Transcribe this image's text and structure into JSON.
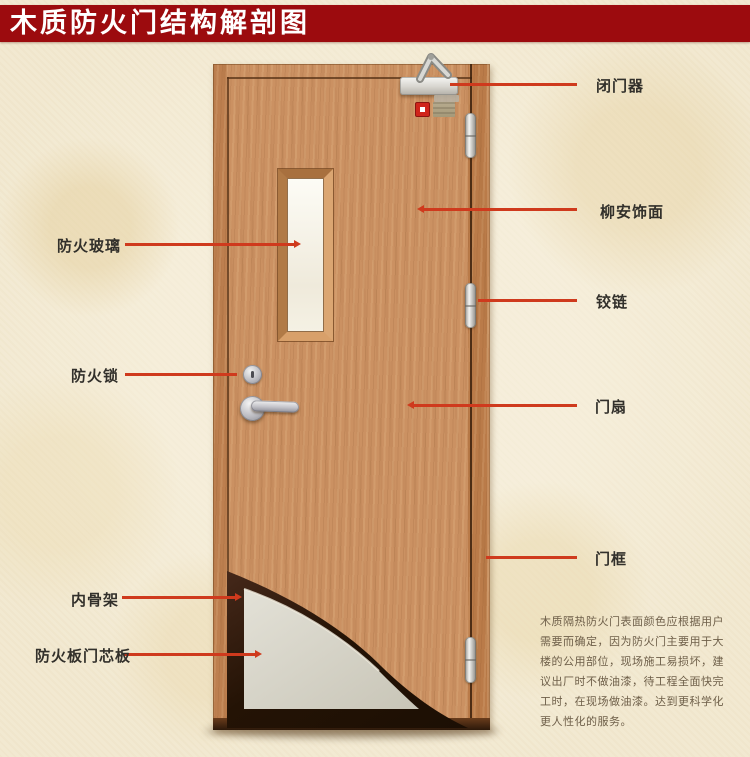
{
  "title": {
    "text": "木质防火门结构解剖图"
  },
  "colors": {
    "banner_red": "#9c0b0e",
    "leader_line_red": "#cf3a1d",
    "door_wood": "#cb9162",
    "core_board_gray": "#d6d3c7",
    "background_beige": "#f2e9d1"
  },
  "labels": {
    "left": [
      {
        "id": "fire-glass",
        "text": "防火玻璃"
      },
      {
        "id": "fire-lock",
        "text": "防火锁"
      },
      {
        "id": "inner-skeleton",
        "text": "内骨架"
      },
      {
        "id": "fire-core-board",
        "text": "防火板门芯板"
      }
    ],
    "right": [
      {
        "id": "door-closer",
        "text": "闭门器"
      },
      {
        "id": "lauan-veneer",
        "text": "柳安饰面"
      },
      {
        "id": "hinge",
        "text": "铰链"
      },
      {
        "id": "door-leaf",
        "text": "门扇"
      },
      {
        "id": "door-frame",
        "text": "门框"
      }
    ]
  },
  "paragraph": {
    "lines": [
      "木质隔热防火门表面颜色应根据用户",
      "需要而确定，因为防火门主要用于大",
      "楼的公用部位，现场施工易损坏，建",
      "议出厂时不做油漆，待工程全面快完",
      "工时，在现场做油漆。达到更科学化",
      "更人性化的服务。"
    ]
  }
}
